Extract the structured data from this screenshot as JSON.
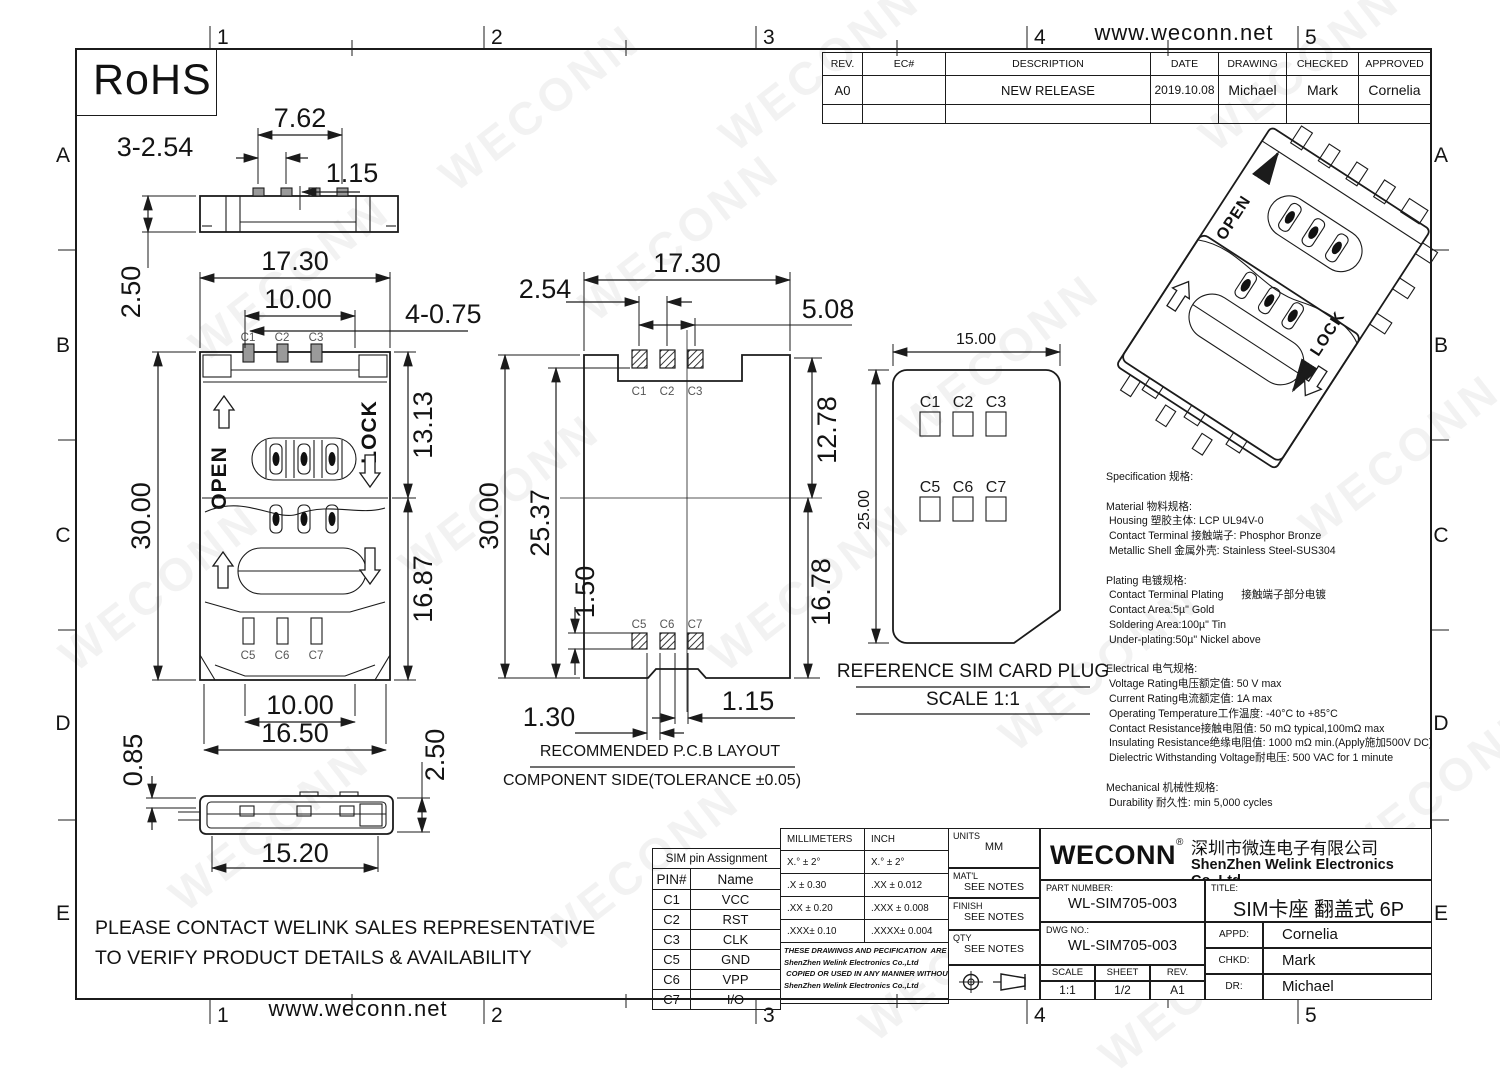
{
  "page": {
    "watermark": "WECONN",
    "rohs": "RoHS",
    "website_top": "www.weconn.net",
    "website_bottom": "www.weconn.net",
    "zone_cols": [
      "1",
      "2",
      "3",
      "4",
      "5"
    ],
    "zone_rows": [
      "A",
      "B",
      "C",
      "D",
      "E"
    ]
  },
  "revision_table": {
    "headers": {
      "rev": "REV.",
      "ec": "EC#",
      "description": "DESCRIPTION",
      "date": "DATE",
      "drawing": "DRAWING",
      "checked": "CHECKED",
      "approved": "APPROVED"
    },
    "row": {
      "rev": "A0",
      "ec": "",
      "description": "NEW RELEASE",
      "date": "2019.10.08",
      "drawing": "Michael",
      "checked": "Mark",
      "approved": "Cornelia"
    }
  },
  "side_view": {
    "dim_pitch": "3-2.54",
    "dim_span": "7.62",
    "dim_offset": "1.15",
    "dim_gap": "2.50"
  },
  "top_view": {
    "dim_width": "17.30",
    "dim_inner": "10.00",
    "dim_holes": "4-0.75",
    "dim_upper": "13.13",
    "dim_total": "30.00",
    "dim_lower": "16.87",
    "open": "OPEN",
    "lock": "LOCK",
    "pins_top": [
      "C1",
      "C2",
      "C3"
    ],
    "pins_bottom": [
      "C5",
      "C6",
      "C7"
    ]
  },
  "bottom_view": {
    "dim_inner": "10.00",
    "dim_body": "16.50",
    "dim_height": "2.50",
    "dim_standoff": "0.85",
    "dim_width": "15.20"
  },
  "pcb_view": {
    "dim_pitch": "2.54",
    "dim_width": "17.30",
    "dim_span": "5.08",
    "dim_total": "30.00",
    "dim_inner": "25.37",
    "dim_upper": "12.78",
    "dim_step": "1.50",
    "dim_lower": "16.78",
    "dim_left": "1.30",
    "dim_right": "1.15",
    "pads_top": [
      "C1",
      "C2",
      "C3"
    ],
    "pads_bottom": [
      "C5",
      "C6",
      "C7"
    ],
    "caption": "RECOMMENDED P.C.B LAYOUT",
    "subcaption": "COMPONENT SIDE(TOLERANCE ±0.05)"
  },
  "card_view": {
    "dim_width": "15.00",
    "dim_height": "25.00",
    "pads_top": [
      "C1",
      "C2",
      "C3"
    ],
    "pads_bottom": [
      "C5",
      "C6",
      "C7"
    ],
    "caption": "REFERENCE SIM CARD PLUG",
    "subcaption": "SCALE 1:1"
  },
  "iso_view": {
    "open": "OPEN",
    "lock": "LOCK"
  },
  "specs": {
    "lines": [
      "Specification 规格:",
      "",
      "Material 物料规格:",
      " Housing 塑胶主体: LCP UL94V-0",
      " Contact Terminal 接触端子: Phosphor Bronze",
      " Metallic Shell 金属外壳: Stainless Steel-SUS304",
      "",
      "Plating 电镀规格:",
      " Contact Terminal Plating      接触端子部分电镀",
      " Contact Area:5µ\" Gold",
      " Soldering Area:100µ\" Tin",
      " Under-plating:50µ\" Nickel above",
      "",
      "Electrical 电气规格:",
      " Voltage Rating电压额定值: 50 V max",
      " Current Rating电流额定值: 1A max",
      " Operating Temperature工作温度: -40°C to +85°C",
      " Contact Resistance接触电阻值: 50 mΩ typical,100mΩ max",
      " Insulating Resistance绝缘电阻值: 1000 mΩ min.(Apply施加500V DC)",
      " Dielectric Withstanding Voltage耐电压: 500 VAC for 1 minute",
      "",
      "Mechanical 机械性规格:",
      " Durability 耐久性: min 5,000 cycles"
    ]
  },
  "notes": {
    "contact_lines": [
      "PLEASE CONTACT WELINK SALES REPRESENTATIVE",
      "TO VERIFY PRODUCT DETAILS & AVAILABILITY"
    ]
  },
  "pin_table": {
    "title": "SIM pin Assignment",
    "col_pin": "PIN#",
    "col_name": "Name",
    "rows": [
      {
        "pin": "C1",
        "name": "VCC"
      },
      {
        "pin": "C2",
        "name": "RST"
      },
      {
        "pin": "C3",
        "name": "CLK"
      },
      {
        "pin": "C5",
        "name": "GND"
      },
      {
        "pin": "C6",
        "name": "VPP"
      },
      {
        "pin": "C7",
        "name": "I/O"
      }
    ]
  },
  "tolerance_table": {
    "col_mm": "MILLIMETERS",
    "col_inch": "INCH",
    "rows_mm": [
      "X.°  ±  2°",
      ".X    ± 0.30",
      ".XX  ± 0.20",
      ".XXX±  0.10"
    ],
    "rows_inch": [
      "X.°  ±  2°",
      ".XX    ± 0.012",
      ".XXX  ± 0.008",
      ".XXXX± 0.004"
    ]
  },
  "legal": {
    "lines": [
      "THESE DRAWINGS AND PECIFICATION  ARE Welink",
      "ShenZhen Welink Electronics Co.,Ltd",
      " COPIED OR USED IN ANY MANNER WITHOUT Welink",
      "ShenZhen Welink Electronics Co.,Ltd"
    ]
  },
  "info_panel": {
    "units_label": "UNITS",
    "units_value": "MM",
    "matl_label": "MAT'L",
    "matl_value": "SEE NOTES",
    "finish_label": "FINISH",
    "finish_value": "SEE NOTES",
    "qty_label": "QTY",
    "qty_value": "SEE NOTES"
  },
  "title_block": {
    "logo": "WECONN",
    "reg": "®",
    "company_cn": "深圳市微连电子有限公司",
    "company_en": "ShenZhen Welink Electronics Co.,Ltd",
    "part_number_label": "PART NUMBER:",
    "part_number": "WL-SIM705-003",
    "title_label": "TITLE:",
    "title": "SIM卡座 翻盖式 6P",
    "dwg_label": "DWG NO.:",
    "dwg": "WL-SIM705-003",
    "scale_label": "SCALE",
    "scale": "1:1",
    "sheet_label": "SHEET",
    "sheet": "1/2",
    "rev_label": "REV.",
    "rev": "A1",
    "appd_label": "APPD:",
    "appd": "Cornelia",
    "chkd_label": "CHKD:",
    "chkd": "Mark",
    "dr_label": "DR:",
    "dr": "Michael"
  }
}
